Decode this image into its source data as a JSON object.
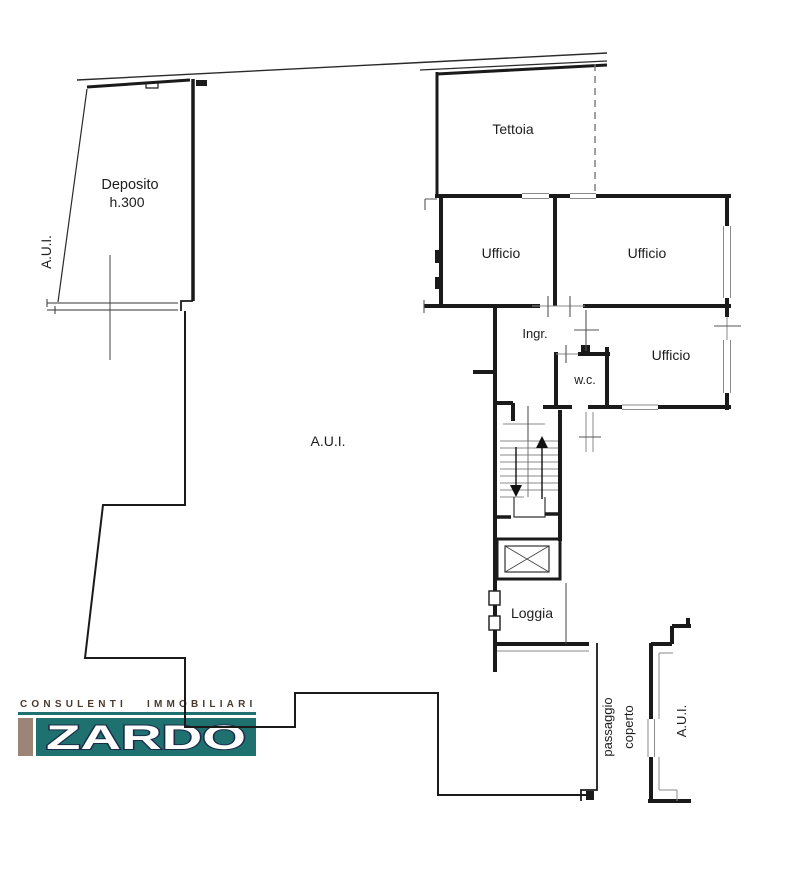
{
  "plan": {
    "background": "#ffffff",
    "wall_color": "#1a1a1a",
    "labels": {
      "deposito": "Deposito",
      "deposito_height": "h.300",
      "aui_left": "A.U.I.",
      "tettoia": "Tettoia",
      "ufficio_top_left": "Ufficio",
      "ufficio_top_right": "Ufficio",
      "ufficio_right": "Ufficio",
      "ingresso": "Ingr.",
      "wc": "w.c.",
      "aui_main": "A.U.I.",
      "loggia": "Loggia",
      "passaggio_line1": "passaggio",
      "passaggio_line2": "coperto",
      "aui_right": "A.U.I."
    }
  },
  "logo": {
    "tagline": "CONSULENTI IMMOBILIARI",
    "brand": "ZARDO",
    "colors": {
      "teal": "#1f7170",
      "tan": "#9c8576",
      "tagline_text": "#4a3a2c",
      "brand_fill": "#ffffff",
      "brand_outline": "#1a2c49"
    }
  }
}
